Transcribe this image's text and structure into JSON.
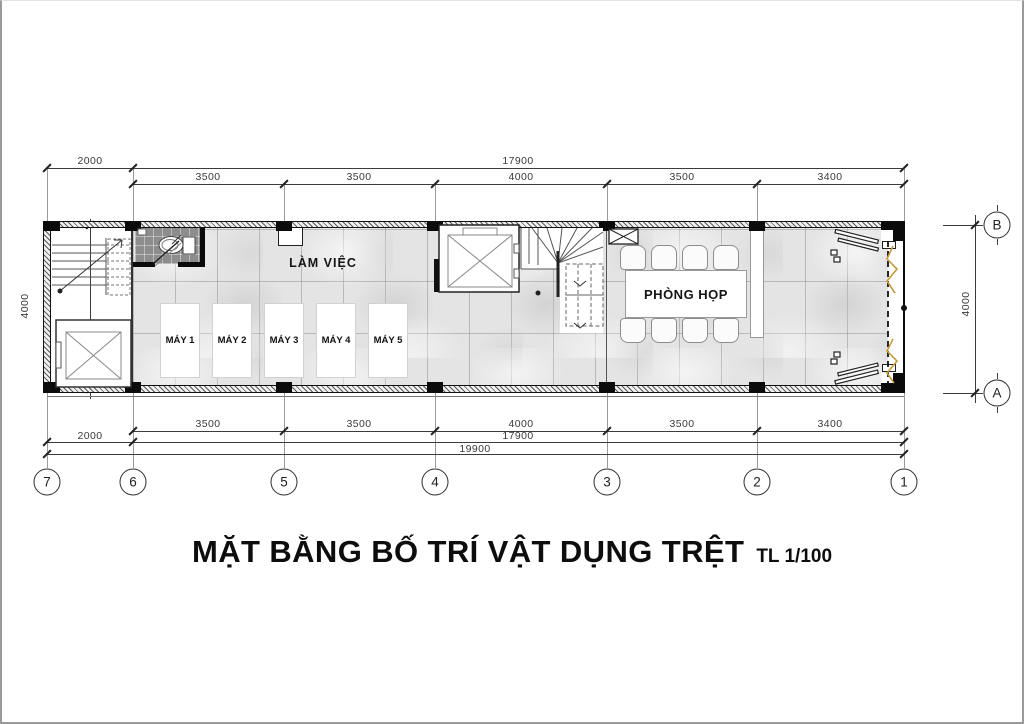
{
  "drawing": {
    "title": "MẶT BẰNG BỐ TRÍ VẬT DỤNG TRỆT",
    "scale": "TL 1/100"
  },
  "rooms": {
    "work_area": "LÀM VIỆC",
    "meeting_room": "PHÒNG HỌP"
  },
  "machines": [
    "MÁY 1",
    "MÁY 2",
    "MÁY 3",
    "MÁY 4",
    "MÁY 5"
  ],
  "dimensions": {
    "top": {
      "left_offset": "2000",
      "overall": "17900",
      "segments": [
        "3500",
        "3500",
        "4000",
        "3500",
        "3400"
      ]
    },
    "bottom": {
      "segments": [
        "3500",
        "3500",
        "4000",
        "3500",
        "3400"
      ],
      "left_offset": "2000",
      "overall": "17900",
      "total": "19900"
    },
    "left_height": "4000",
    "right_height": "4000"
  },
  "grid": {
    "column_bubbles": [
      "7",
      "6",
      "5",
      "4",
      "3",
      "2",
      "1"
    ],
    "row_bubbles": [
      "B",
      "A"
    ]
  },
  "colors": {
    "floor_tile": "#e4e4e4",
    "wc_tile": "#8d8d8d",
    "wall": "#101010",
    "door_accent": "#c79a3d",
    "dim_line": "#3c3c3c"
  }
}
